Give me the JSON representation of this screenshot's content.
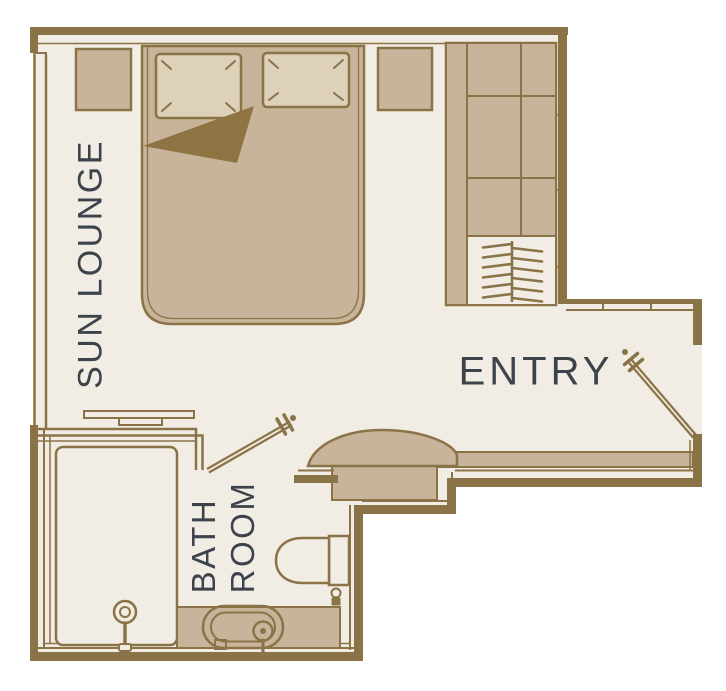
{
  "diagram": {
    "kind": "hotel-room-floor-plan",
    "rooms": [
      {
        "name": "sun-lounge",
        "label": "SUN LOUNGE"
      },
      {
        "name": "entry",
        "label": "ENTRY"
      },
      {
        "name": "bathroom",
        "label": "BATH ROOM",
        "label_lines": [
          "BATH",
          "ROOM"
        ]
      }
    ],
    "fixtures": [
      "double-bed",
      "pillow-left",
      "pillow-right",
      "blanket-fold",
      "nightstand-left",
      "nightstand-right",
      "wardrobe-shelves",
      "wardrobe-hanging-rail",
      "clothes-hangers",
      "towel-rail",
      "entry-console",
      "entry-door",
      "bathroom-door",
      "shower",
      "shower-head",
      "vanity-counter",
      "basin",
      "faucet",
      "toilet",
      "window-wall"
    ],
    "colors": {
      "background": "#ffffff",
      "floor": "#f1ece4",
      "wall": "#8a7347",
      "furniture_fill": "#c7b49a",
      "pillow_fill": "#ddd1ba",
      "blanket_fold": "#8f7443",
      "label_text": "#3d434b"
    }
  }
}
